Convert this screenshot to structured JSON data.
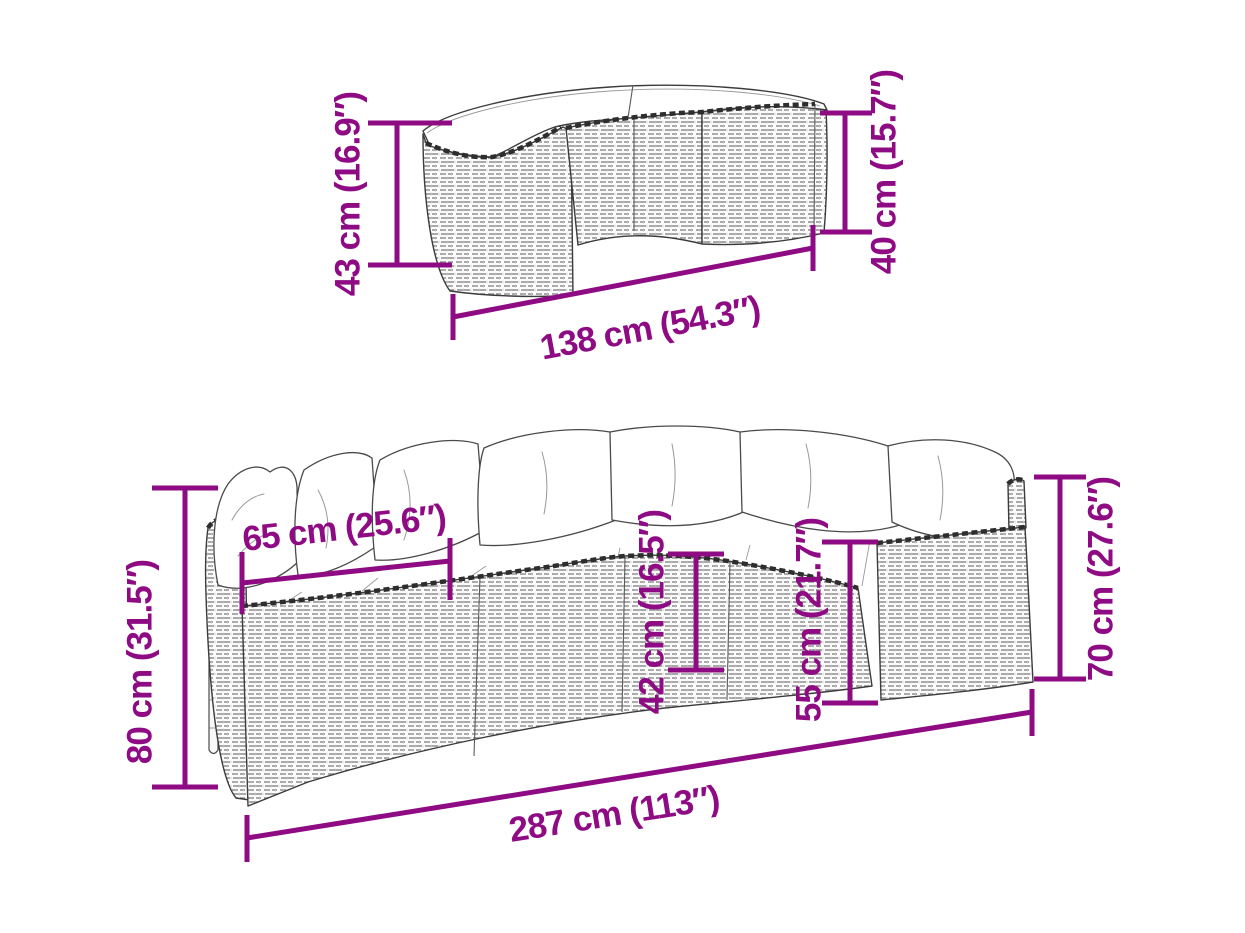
{
  "colors": {
    "accent": "#8E0B84",
    "drawing_outline": "#3C3C3C",
    "background": "#FFFFFF"
  },
  "figure": {
    "description": "Dimension diagram of a half-round poly rattan garden sofa set: curved table/stool (top) and half-round sofa with cushions (bottom)",
    "pieces": {
      "table": "curved-rattan-table",
      "sofa": "half-round-rattan-sofa"
    }
  },
  "dims": {
    "table_height_left": {
      "label": "43 cm (16.9″)"
    },
    "table_height_right": {
      "label": "40 cm (15.7″)"
    },
    "table_width": {
      "label": "138 cm (54.3″)"
    },
    "sofa_height_left": {
      "label": "80 cm (31.5″)"
    },
    "sofa_seat_depth": {
      "label": "65 cm (25.6″)"
    },
    "sofa_seat_height": {
      "label": "42 cm (16.5″)"
    },
    "sofa_back_height": {
      "label": "55 cm (21.7″)"
    },
    "sofa_arm_height": {
      "label": "70 cm (27.6″)"
    },
    "sofa_width": {
      "label": "287 cm (113″)"
    }
  }
}
